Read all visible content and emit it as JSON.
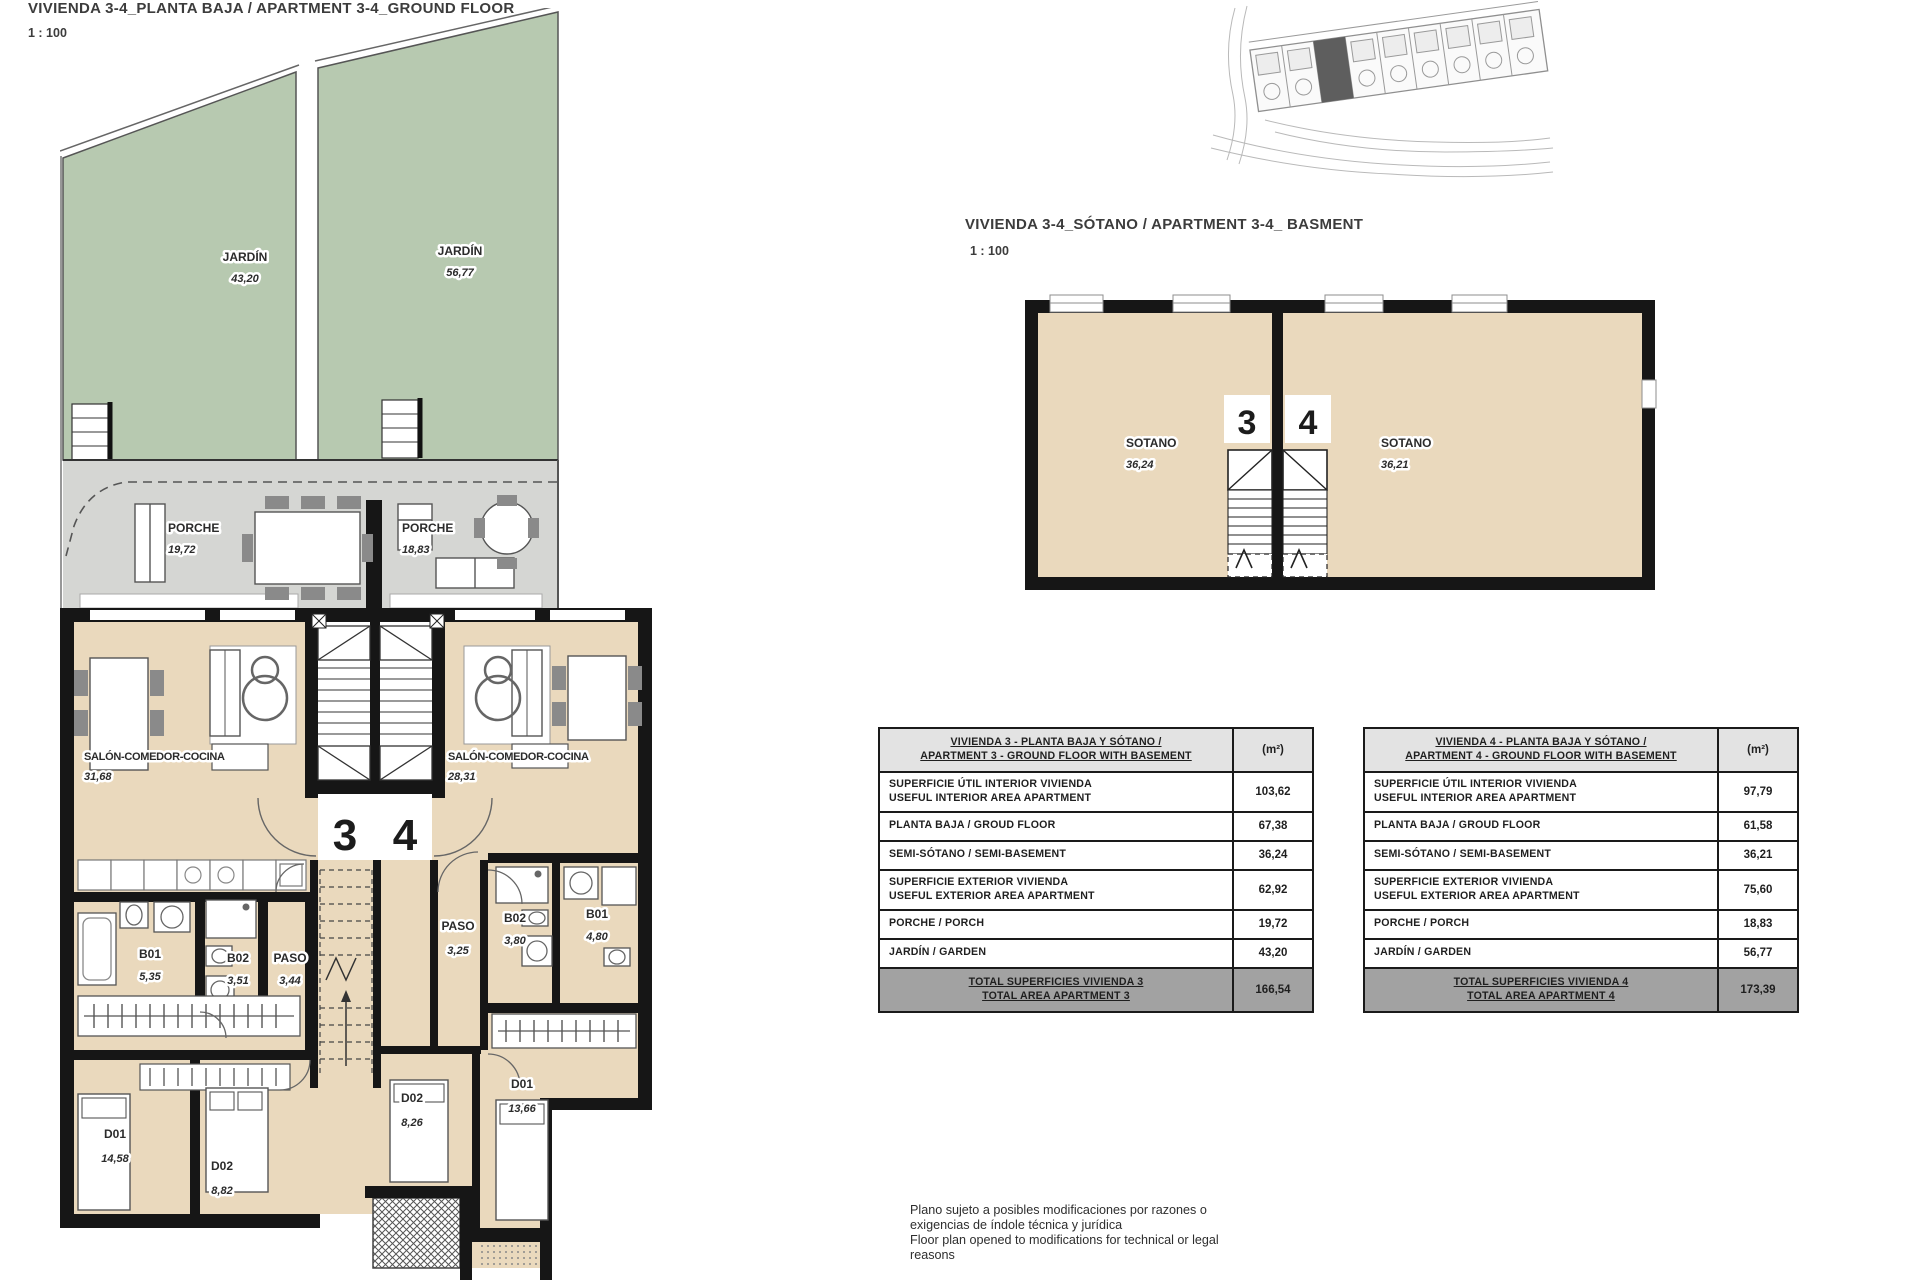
{
  "colors": {
    "garden_green": "#b7c9b0",
    "porch_gray": "#d5d6d3",
    "interior_beige": "#ead9bd",
    "wall_black": "#161616",
    "table_header_bg": "#e3e3e3",
    "table_total_bg": "#a2a2a2"
  },
  "ground_floor": {
    "title": "VIVIENDA 3-4_PLANTA BAJA / APARTMENT 3-4_GROUND FLOOR",
    "scale": "1 : 100",
    "unit3_number": "3",
    "unit4_number": "4",
    "labels": {
      "jardin3_name": "JARDÍN",
      "jardin3_area": "43,20",
      "jardin4_name": "JARDÍN",
      "jardin4_area": "56,77",
      "porche3_name": "PORCHE",
      "porche3_area": "19,72",
      "porche4_name": "PORCHE",
      "porche4_area": "18,83",
      "salon3_name": "SALÓN-COMEDOR-COCINA",
      "salon3_area": "31,68",
      "salon4_name": "SALÓN-COMEDOR-COCINA",
      "salon4_area": "28,31",
      "b01_3_name": "B01",
      "b01_3_area": "5,35",
      "b02_3_name": "B02",
      "b02_3_area": "3,51",
      "paso3_name": "PASO",
      "paso3_area": "3,44",
      "paso4_name": "PASO",
      "paso4_area": "3,25",
      "b02_4_name": "B02",
      "b02_4_area": "3,80",
      "b01_4_name": "B01",
      "b01_4_area": "4,80",
      "d01_3_name": "D01",
      "d01_3_area": "14,58",
      "d02_3_name": "D02",
      "d02_3_area": "8,82",
      "d02_4_name": "D02",
      "d02_4_area": "8,26",
      "d01_4_name": "D01",
      "d01_4_area": "13,66"
    }
  },
  "basement": {
    "title": "VIVIENDA 3-4_SÓTANO  / APARTMENT 3-4_ BASMENT",
    "scale": "1 : 100",
    "unit3_number": "3",
    "unit4_number": "4",
    "labels": {
      "sotano3_name": "SOTANO",
      "sotano3_area": "36,24",
      "sotano4_name": "SOTANO",
      "sotano4_area": "36,21"
    }
  },
  "tables": [
    {
      "title_line1": "VIVIENDA 3 - PLANTA BAJA Y SÓTANO /",
      "title_line2": "APARTMENT 3 - GROUND FLOOR WITH BASEMENT",
      "unit_label": "(m²)",
      "rows": [
        {
          "line1": "SUPERFICIE ÚTIL INTERIOR VIVIENDA",
          "line2": "USEFUL INTERIOR AREA APARTMENT",
          "value": "103,62"
        },
        {
          "line1": "PLANTA BAJA / GROUD FLOOR",
          "line2": "",
          "value": "67,38"
        },
        {
          "line1": "SEMI-SÓTANO / SEMI-BASEMENT",
          "line2": "",
          "value": "36,24"
        },
        {
          "line1": "SUPERFICIE EXTERIOR VIVIENDA",
          "line2": "USEFUL EXTERIOR AREA APARTMENT",
          "value": "62,92"
        },
        {
          "line1": "PORCHE / PORCH",
          "line2": "",
          "value": "19,72"
        },
        {
          "line1": "JARDÍN / GARDEN",
          "line2": "",
          "value": "43,20"
        }
      ],
      "total_line1": "TOTAL SUPERFICIES VIVIENDA 3",
      "total_line2": "TOTAL AREA APARTMENT 3",
      "total_value": "166,54"
    },
    {
      "title_line1": "VIVIENDA 4 - PLANTA BAJA Y SÓTANO /",
      "title_line2": "APARTMENT 4 - GROUND FLOOR WITH BASEMENT",
      "unit_label": "(m²)",
      "rows": [
        {
          "line1": "SUPERFICIE ÚTIL INTERIOR VIVIENDA",
          "line2": "USEFUL INTERIOR AREA APARTMENT",
          "value": "97,79"
        },
        {
          "line1": "PLANTA BAJA / GROUD FLOOR",
          "line2": "",
          "value": "61,58"
        },
        {
          "line1": "SEMI-SÓTANO / SEMI-BASEMENT",
          "line2": "",
          "value": "36,21"
        },
        {
          "line1": "SUPERFICIE EXTERIOR VIVIENDA",
          "line2": "USEFUL EXTERIOR AREA APARTMENT",
          "value": "75,60"
        },
        {
          "line1": "PORCHE / PORCH",
          "line2": "",
          "value": "18,83"
        },
        {
          "line1": "JARDÍN / GARDEN",
          "line2": "",
          "value": "56,77"
        }
      ],
      "total_line1": "TOTAL SUPERFICIES VIVIENDA 4",
      "total_line2": "TOTAL AREA APARTMENT 4",
      "total_value": "173,39"
    }
  ],
  "disclaimer": {
    "line1": "Plano sujeto a posibles modificaciones por razones o",
    "line2": "exigencias de índole técnica y jurídica",
    "line3": "Floor plan opened to modifications for technical or legal",
    "line4": "reasons"
  }
}
